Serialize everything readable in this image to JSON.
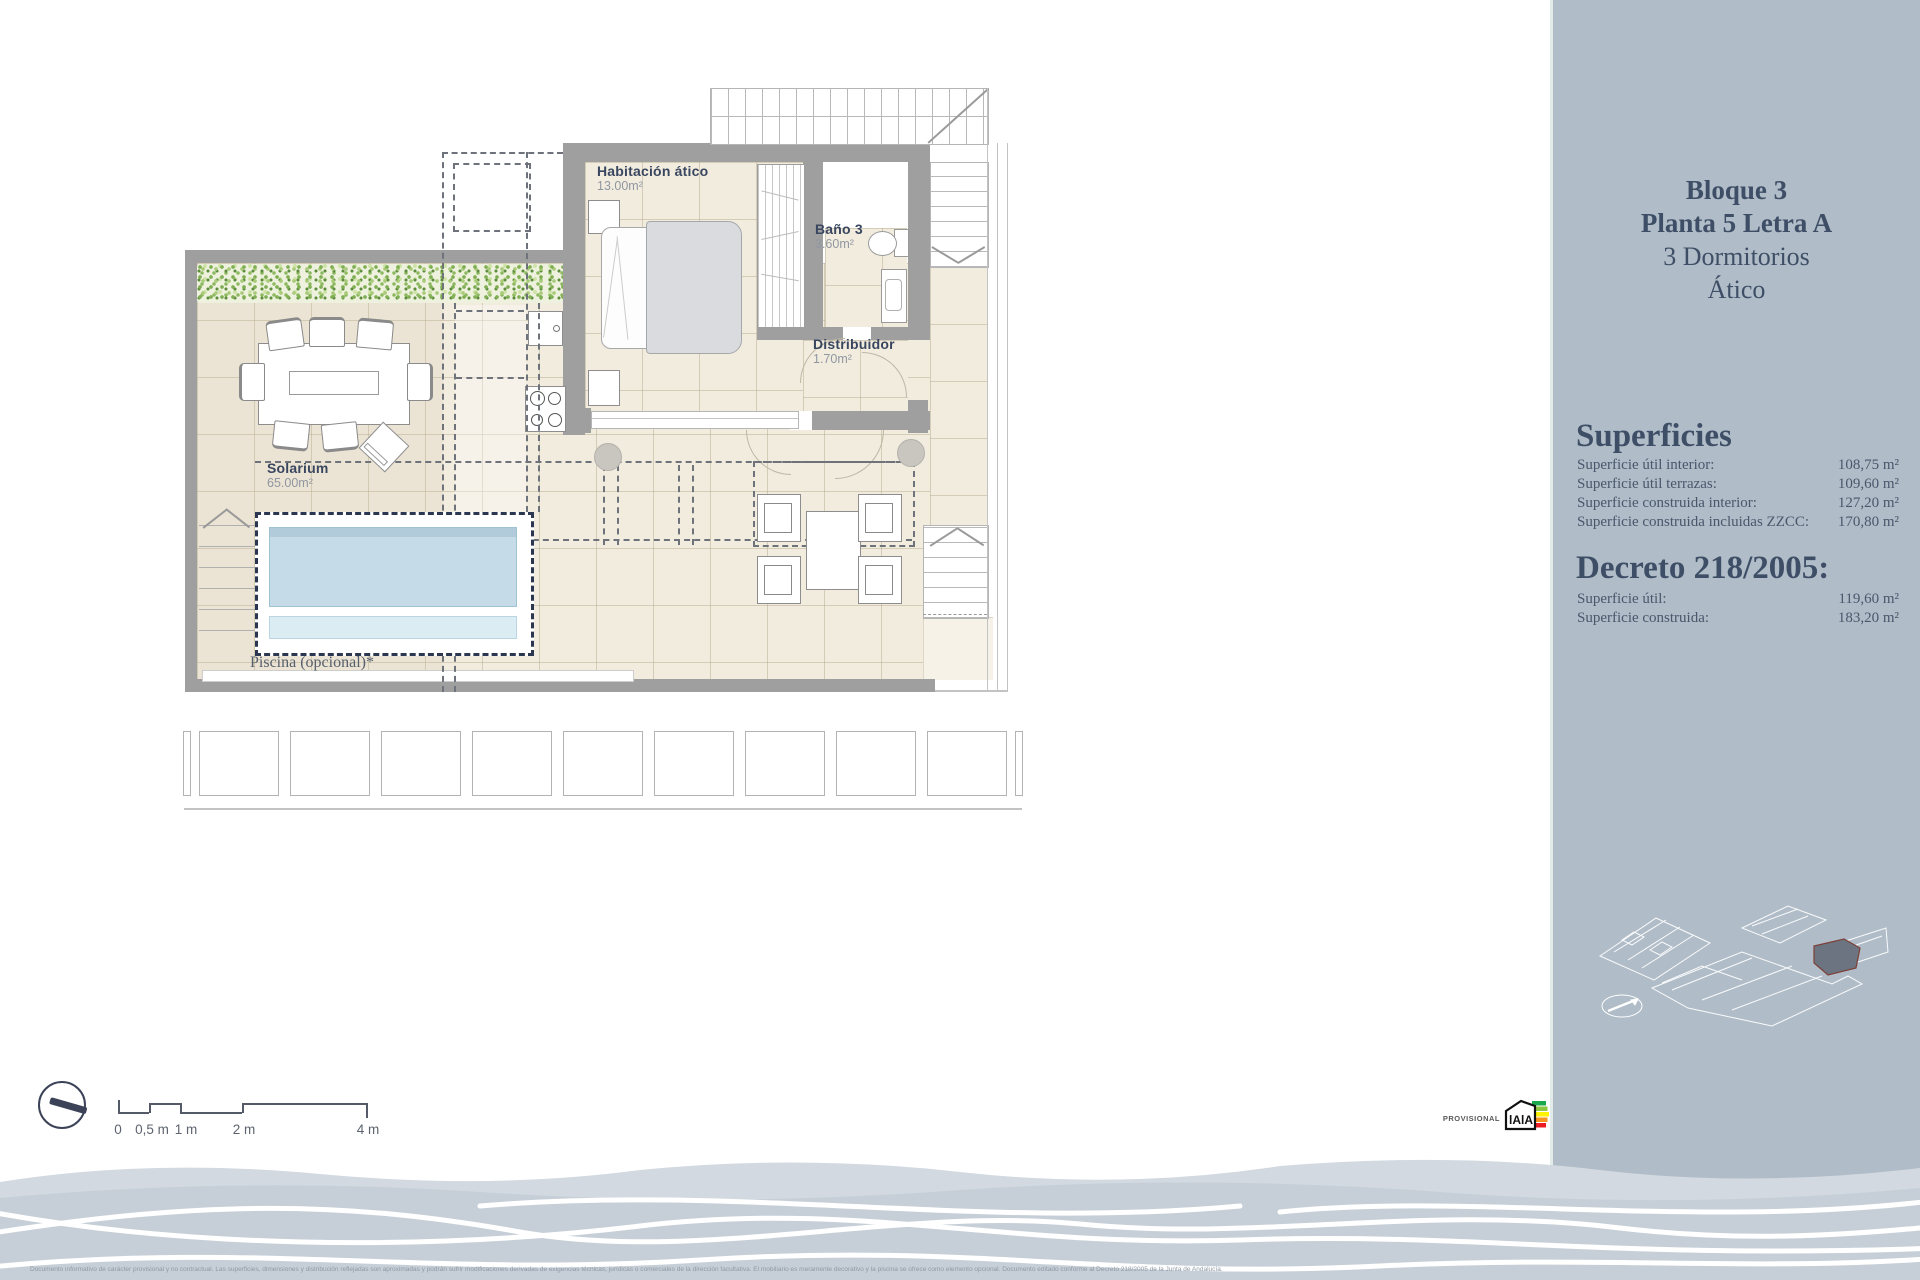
{
  "sidebar": {
    "title_lines": [
      "Bloque 3",
      "Planta 5  Letra A",
      "3 Dormitorios",
      "Ático"
    ],
    "superficies_heading": "Superficies",
    "superficies_rows": [
      {
        "label": "Superficie útil interior:",
        "value": "108,75 m²"
      },
      {
        "label": "Superficie útil terrazas:",
        "value": "109,60 m²"
      },
      {
        "label": "Superficie construida interior:",
        "value": "127,20 m²"
      },
      {
        "label": "Superficie construida incluidas ZZCC:",
        "value": "170,80 m²"
      }
    ],
    "decreto_heading": "Decreto 218/2005:",
    "decreto_rows": [
      {
        "label": "Superficie útil:",
        "value": "119,60 m²"
      },
      {
        "label": "Superficie construida:",
        "value": "183,20 m²"
      }
    ]
  },
  "plan": {
    "rooms": [
      {
        "name": "Habitación ático",
        "area": "13.00m²"
      },
      {
        "name": "Baño 3",
        "area": "3.60m²"
      },
      {
        "name": "Distribuidor",
        "area": "1.70m²"
      },
      {
        "name": "Solarium",
        "area": "65.00m²"
      }
    ],
    "pool_label": "Piscina (opcional)*"
  },
  "scale_bar": {
    "labels": [
      "0",
      "0,5 m",
      "1 m",
      "2 m",
      "4 m"
    ]
  },
  "footer": {
    "provisional_label": "PROVISIONAL",
    "energy_logo_text": "lAlA",
    "disclaimer": "Documento informativo de carácter provisional y no contractual. Las superficies, dimensiones y distribución reflejadas son aproximadas y podrán sufrir modificaciones derivadas de exigencias técnicas, jurídicas o comerciales de la dirección facultativa. El mobiliario es meramente decorativo y la piscina se ofrece como elemento opcional. Documento editado conforme al Decreto 218/2005 de la Junta de Andalucía."
  },
  "colors": {
    "sidebar_bg": "#b0bcc7",
    "accent_navy": "#3e4e66",
    "wall_gray": "#9f9f9f",
    "floor_beige": "#f2ecdf",
    "pool_blue": "#c5dce8",
    "hedge_green": "#86b152",
    "wave_gray": "#c6cfd7"
  }
}
